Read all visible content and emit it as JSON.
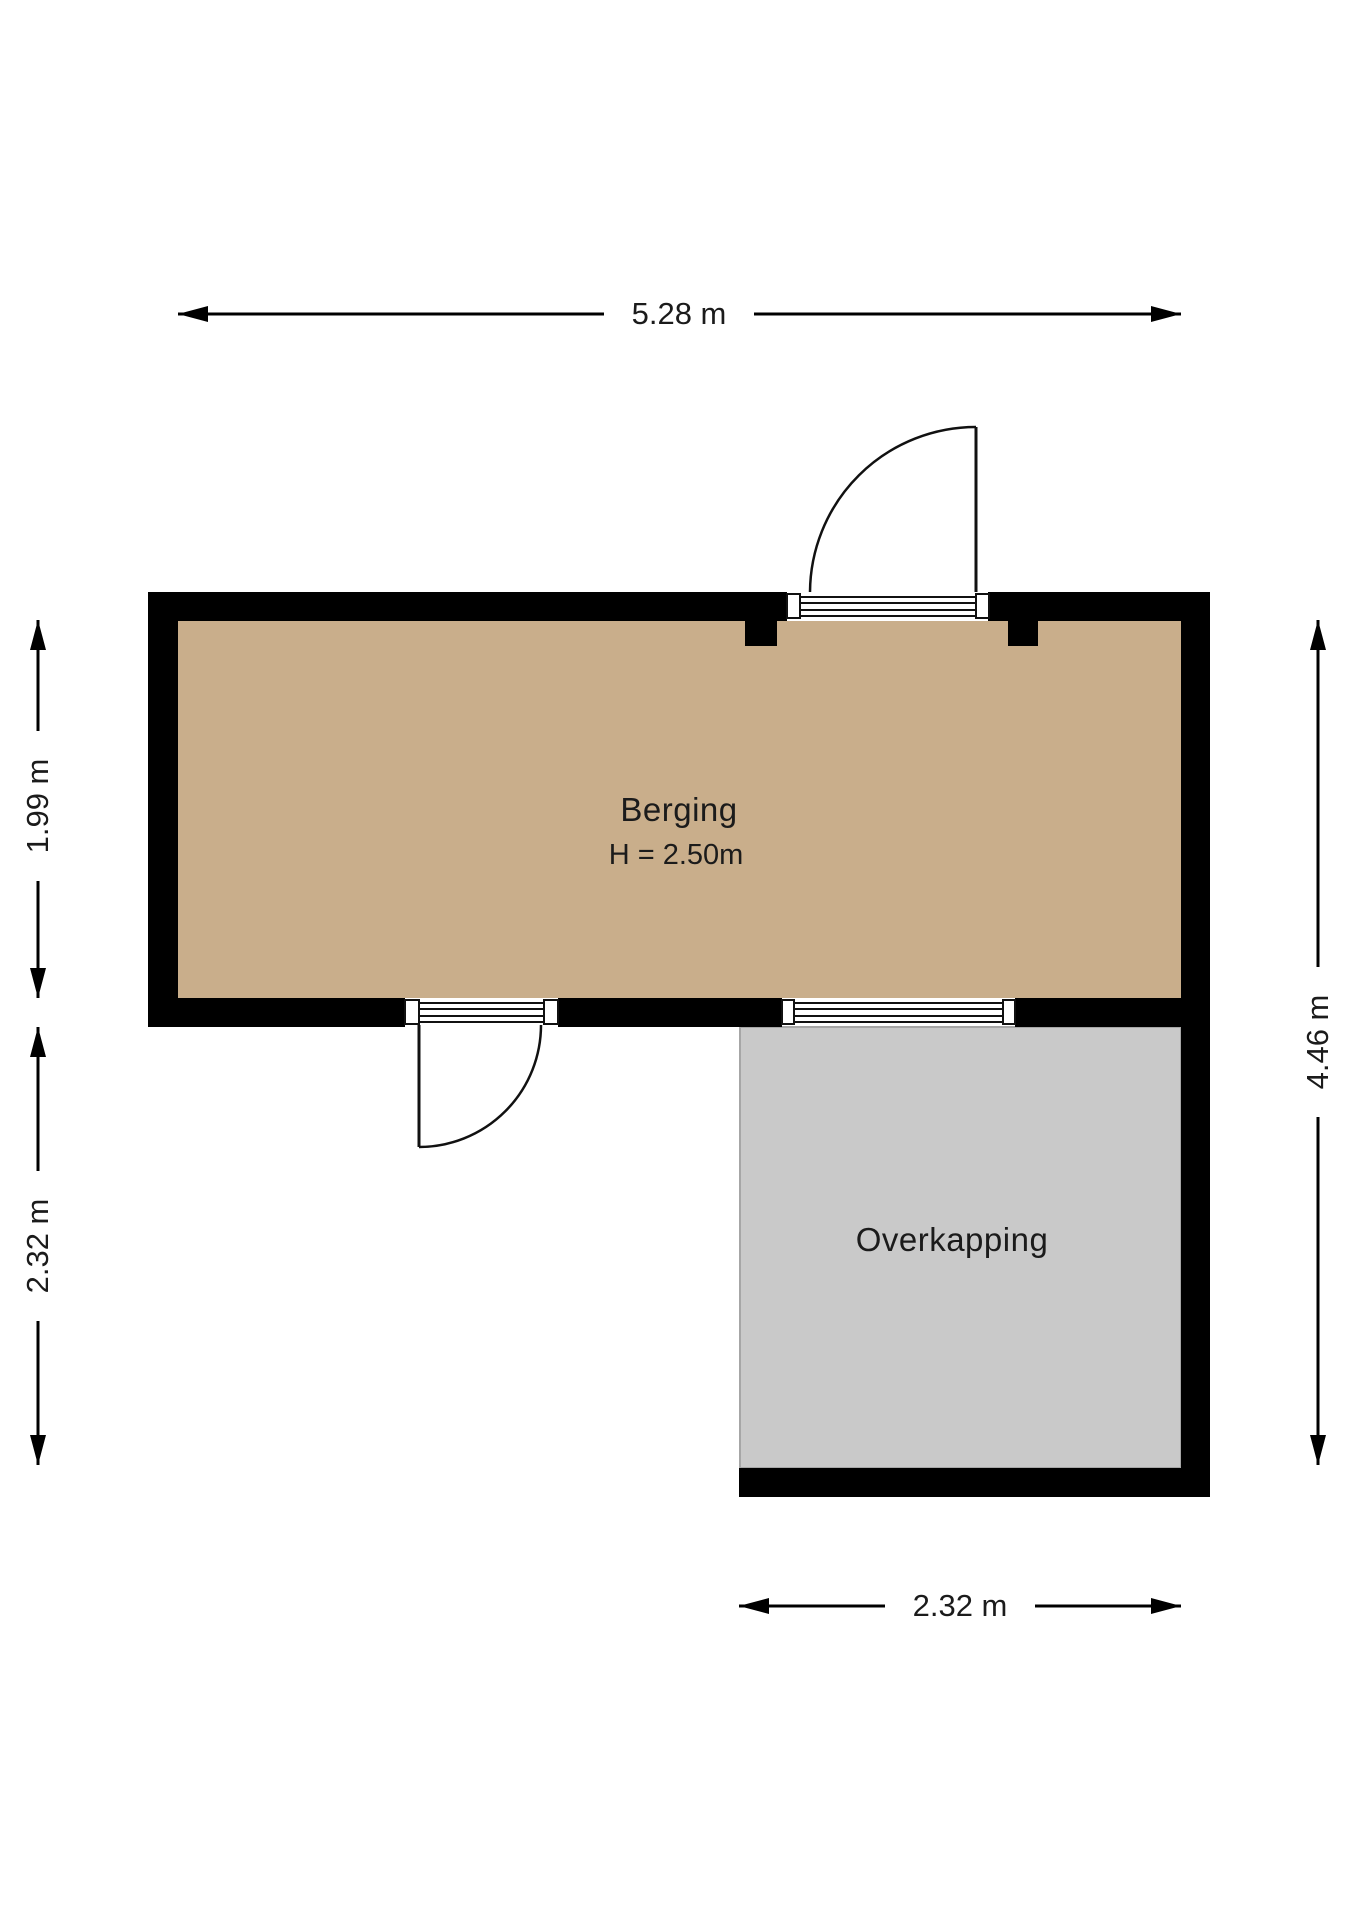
{
  "rooms": {
    "berging": {
      "label": "Berging",
      "height_label": "H = 2.50m"
    },
    "overkapping": {
      "label": "Overkapping"
    }
  },
  "dimensions": {
    "top_width": "5.28 m",
    "berging_depth": "1.99 m",
    "overkapping_depth": "2.32 m",
    "total_depth": "4.46 m",
    "overkapping_width": "2.32 m"
  },
  "colors": {
    "wall": "#000000",
    "berging_floor": "#c9ae8b",
    "overkapping_floor": "#c9c9c9",
    "overkapping_border": "#a6a6a6",
    "line": "#111111"
  }
}
